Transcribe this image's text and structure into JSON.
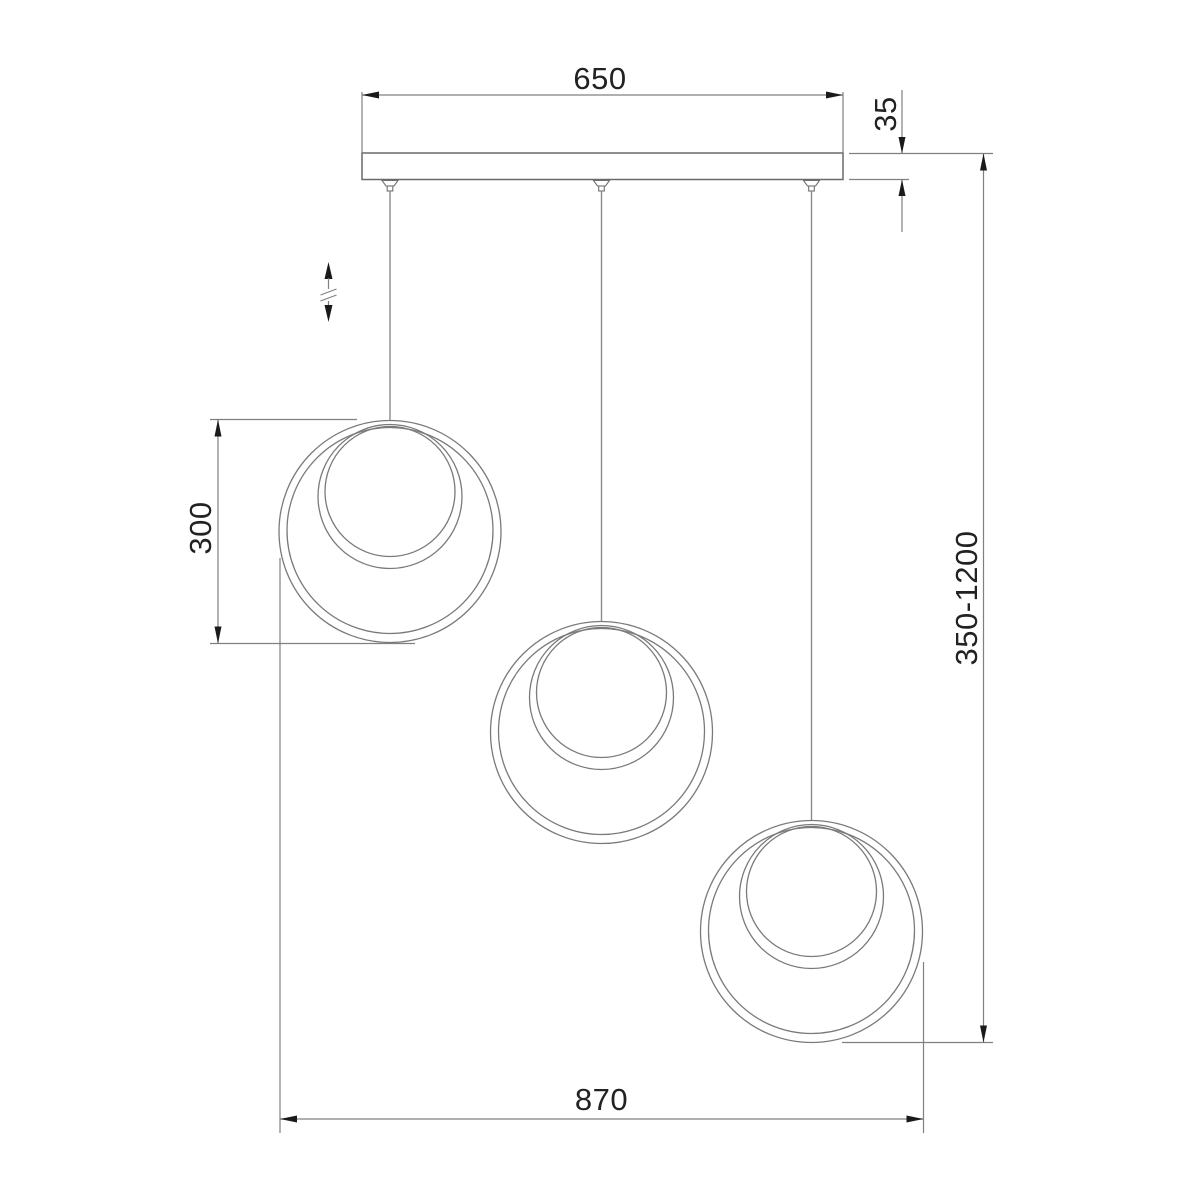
{
  "drawing": {
    "subject": "pendant chandelier technical dimension drawing, 3 hanging double-ring shades on cords from a linear ceiling canopy",
    "background_color": "#ffffff",
    "line_color": "#7a7a7a",
    "text_color": "#222222",
    "arrow_color": "#1a1a1a",
    "dims": {
      "canopy_width": "650",
      "canopy_thickness": "35",
      "ring_diameter": "300",
      "overall_width": "870",
      "height_range": "350-1200"
    },
    "icons": {
      "height_adjust": "double-headed vertical arrow with break mark (adjustable suspension height)"
    }
  }
}
